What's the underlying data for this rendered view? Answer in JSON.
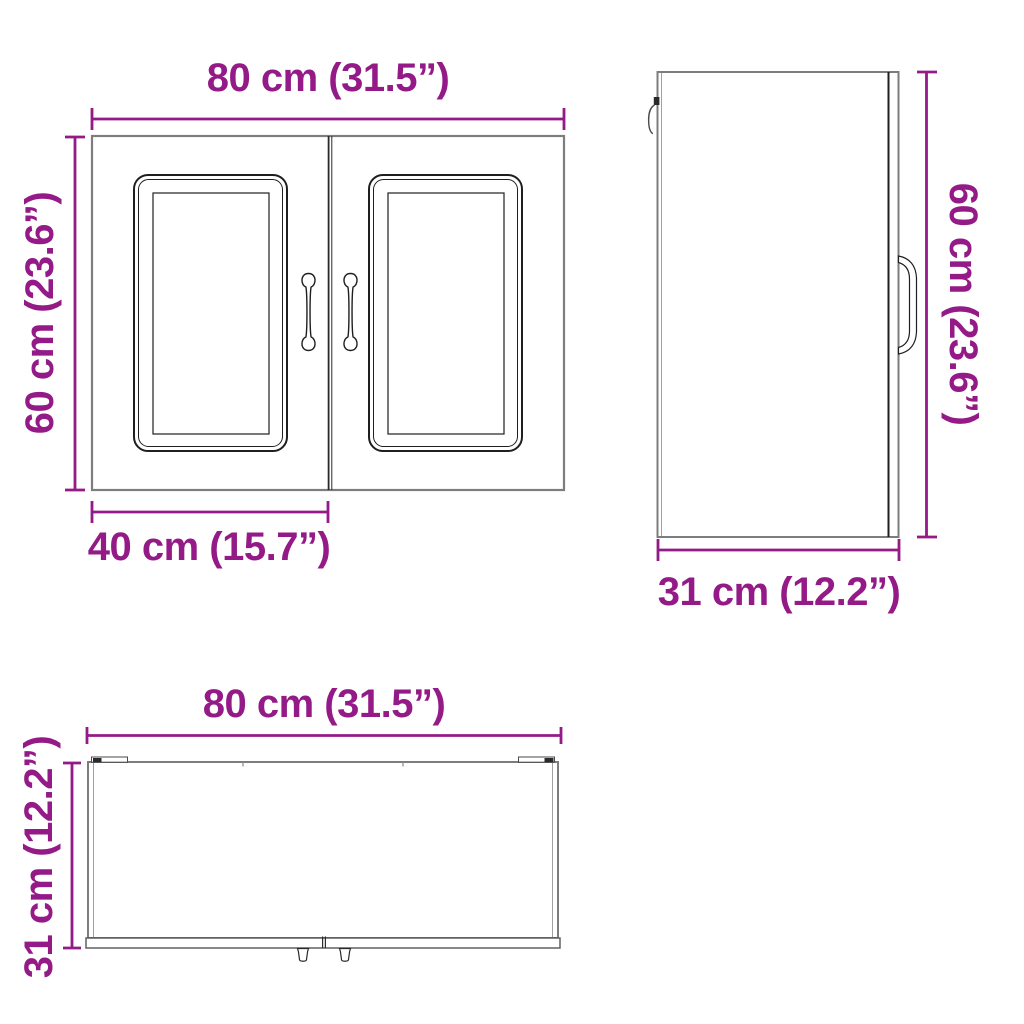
{
  "colors": {
    "accent": "#941a87",
    "outline_gray": "#7d7d7d",
    "detail_dark": "#1f1f1f"
  },
  "diagram": {
    "type": "furniture-dimension-drawing",
    "views": {
      "front": {
        "width_label": "80 cm (31.5”)",
        "height_label": "60 cm (23.6”)",
        "door_width_label": "40 cm (15.7”)"
      },
      "side": {
        "height_label": "60 cm (23.6”)",
        "depth_label": "31 cm (12.2”)"
      },
      "top": {
        "width_label": "80 cm (31.5”)",
        "depth_label": "31 cm (12.2”)"
      }
    }
  }
}
